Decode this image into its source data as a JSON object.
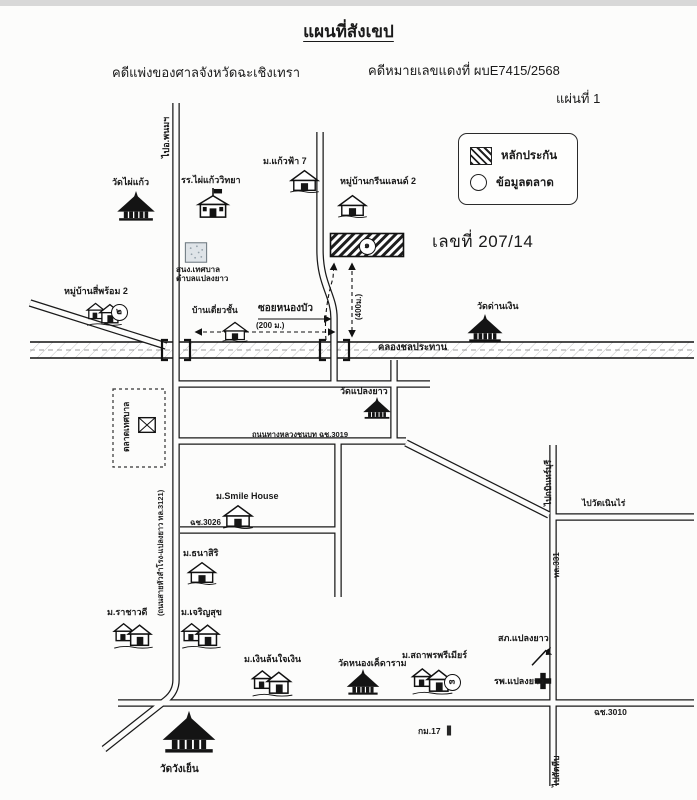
{
  "title": "แผนที่สังเขป",
  "header": {
    "court_line": "คดีแพ่งของศาลจังหวัดฉะเชิงเทรา",
    "case_no_line": "คดีหมายเลขแดงที่ ผบE7415/2568",
    "sheet_no": "แผ่นที่ 1"
  },
  "legend": {
    "collateral_label": "หลักประกัน",
    "market_label": "ข้อมูลตลาด"
  },
  "parcel": {
    "address_label": "เลขที่ 207/14"
  },
  "map": {
    "labels": [
      {
        "id": "to-phanom-road-label",
        "text": "ไปอ.พนมฯ",
        "x": 161,
        "y": 158,
        "rot": -90,
        "size": 9
      },
      {
        "id": "soi-nong-bua-label",
        "text": "ซอยหนองบัว",
        "x": 258,
        "y": 303,
        "size": 10,
        "bold": true
      },
      {
        "id": "soi-length-label",
        "text": "(200 ม.)",
        "x": 256,
        "y": 322,
        "size": 8
      },
      {
        "id": "parcel-distance-label",
        "text": "(400ม.)",
        "x": 355,
        "y": 320,
        "rot": -90,
        "size": 8
      },
      {
        "id": "canal-label",
        "text": "คลองชลประทาน",
        "x": 378,
        "y": 343,
        "size": 9.5,
        "bold": true
      },
      {
        "id": "road-3019-label",
        "text": "ถนนทางหลวงชนบท ฉช.3019",
        "x": 252,
        "y": 431,
        "size": 7.5
      },
      {
        "id": "road-3026-label",
        "text": "ฉช.3026",
        "x": 190,
        "y": 519,
        "size": 8
      },
      {
        "id": "road-3121-label",
        "text": "(ถนนสายหัวสำโรง-แปลงยาว ทล.3121)",
        "x": 157,
        "y": 616,
        "rot": -90,
        "size": 7.5
      },
      {
        "id": "municipal-market-label",
        "text": "ตลาดเทศบาล",
        "x": 122,
        "y": 452,
        "rot": -90,
        "size": 8.5
      },
      {
        "id": "highway-331-label",
        "text": "ทล.331",
        "x": 553,
        "y": 578,
        "rot": -90,
        "size": 8
      },
      {
        "id": "to-kabin-buri-label",
        "text": "ไปกบินทร์บุรี",
        "x": 544,
        "y": 506,
        "rot": -90,
        "size": 8.5
      },
      {
        "id": "to-wat-noen-rai-label",
        "text": "ไปวัดเนินไร่",
        "x": 582,
        "y": 499,
        "size": 8.5,
        "bold": true
      },
      {
        "id": "road-3010-label",
        "text": "ฉช.3010",
        "x": 594,
        "y": 708,
        "size": 8.5
      },
      {
        "id": "to-sattahip-label",
        "text": "ไปสัตหีบ",
        "x": 552,
        "y": 787,
        "rot": -90,
        "size": 8.5
      },
      {
        "id": "km-marker-label",
        "text": "กม.17",
        "x": 418,
        "y": 727,
        "size": 8.5
      }
    ],
    "places": [
      {
        "id": "wat-phai-kaeo",
        "name": "วัดไผ่แก้ว",
        "icon": "temple",
        "ix": 114,
        "iy": 191,
        "iw": 44,
        "ih": 30,
        "lx": 112,
        "ly": 177
      },
      {
        "id": "school-phai-kaeo-wittaya",
        "name": "รร.ไผ่แก้ววิทยา",
        "icon": "school",
        "ix": 193,
        "iy": 188,
        "iw": 40,
        "ih": 33,
        "lx": 181,
        "ly": 175
      },
      {
        "id": "mu-kaeo-fa-7",
        "name": "ม.แก้วฟ้า 7",
        "icon": "house",
        "ix": 288,
        "iy": 168,
        "iw": 33,
        "ih": 25,
        "lx": 263,
        "ly": 156
      },
      {
        "id": "mu-ban-green-land-2",
        "name": "หมู่บ้านกรีนแลนด์ 2",
        "icon": "house",
        "ix": 336,
        "iy": 193,
        "iw": 33,
        "ih": 25,
        "lx": 340,
        "ly": 176
      },
      {
        "id": "municipal-office",
        "name": "สนง.เทศบาล",
        "name2": "ตำบลแปลงยาว",
        "icon": "office",
        "ix": 183,
        "iy": 241,
        "iw": 26,
        "ih": 23,
        "lx": 176,
        "ly": 266,
        "ls": 8
      },
      {
        "id": "mu-ban-si-phrom-2",
        "name": "หมู่บ้านสี่พร้อม 2",
        "icon": "village",
        "ix": 85,
        "iy": 300,
        "iw": 38,
        "ih": 27,
        "lx": 64,
        "ly": 286
      },
      {
        "id": "detached-house",
        "name": "บ้านเดี่ยวชั้น",
        "icon": "house",
        "ix": 221,
        "iy": 320,
        "iw": 28,
        "ih": 22,
        "lx": 192,
        "ly": 306,
        "ls": 8.5
      },
      {
        "id": "wat-dan-ngoen",
        "name": "วัดด่านเงิน",
        "icon": "temple",
        "ix": 463,
        "iy": 314,
        "iw": 44,
        "ih": 28,
        "lx": 477,
        "ly": 301
      },
      {
        "id": "wat-plaeng-yao",
        "name": "วัดแปลงยาว",
        "icon": "temple",
        "ix": 360,
        "iy": 397,
        "iw": 34,
        "ih": 22,
        "lx": 340,
        "ly": 386
      },
      {
        "id": "municipal-market-stall",
        "name": "",
        "icon": "market",
        "ix": 136,
        "iy": 414,
        "iw": 22,
        "ih": 22
      },
      {
        "id": "mu-smile-house",
        "name": "ม.Smile House",
        "icon": "house",
        "ix": 221,
        "iy": 503,
        "iw": 34,
        "ih": 26,
        "lx": 216,
        "ly": 491
      },
      {
        "id": "mu-thanasiri",
        "name": "ม.ธนาสิริ",
        "icon": "house",
        "ix": 186,
        "iy": 560,
        "iw": 32,
        "ih": 25,
        "lx": 183,
        "ly": 548
      },
      {
        "id": "mu-rachawadee",
        "name": "ม.ราชาวดี",
        "icon": "village",
        "ix": 112,
        "iy": 620,
        "iw": 42,
        "ih": 30,
        "lx": 107,
        "ly": 607
      },
      {
        "id": "mu-charoensuk",
        "name": "ม.เจริญสุข",
        "icon": "village",
        "ix": 180,
        "iy": 620,
        "iw": 42,
        "ih": 30,
        "lx": 181,
        "ly": 607
      },
      {
        "id": "mu-ngoen-lon-jai-ngoen",
        "name": "ม.เงินล้นใจเงิน",
        "icon": "village",
        "ix": 250,
        "iy": 667,
        "iw": 44,
        "ih": 31,
        "lx": 244,
        "ly": 654
      },
      {
        "id": "wat-nong-khet-aram",
        "name": "วัดหนองเค็ดาราม",
        "icon": "temple",
        "ix": 344,
        "iy": 669,
        "iw": 38,
        "ih": 26,
        "lx": 338,
        "ly": 658
      },
      {
        "id": "mu-sathaporn-premier",
        "name": "ม.สถาพรพรีเมียร์",
        "icon": "village",
        "ix": 410,
        "iy": 665,
        "iw": 44,
        "ih": 31,
        "lx": 402,
        "ly": 650
      },
      {
        "id": "police-station-plaeng-yao",
        "name": "สภ.แปลงยาว",
        "icon": "police",
        "ix": 528,
        "iy": 644,
        "iw": 24,
        "ih": 23,
        "lx": 498,
        "ly": 633
      },
      {
        "id": "hospital-plaeng-yao",
        "name": "รพ.แปลงยาว",
        "icon": "hospital",
        "ix": 533,
        "iy": 671,
        "iw": 20,
        "ih": 20,
        "lx": 494,
        "ly": 676
      },
      {
        "id": "wat-wang-yen",
        "name": "วัดวังเย็น",
        "icon": "temple",
        "ix": 160,
        "iy": 707,
        "iw": 58,
        "ih": 50,
        "lx": 160,
        "ly": 764,
        "ls": 10
      },
      {
        "id": "km-post",
        "name": "",
        "icon": "km",
        "ix": 444,
        "iy": 724,
        "iw": 10,
        "ih": 13
      }
    ],
    "markers": [
      {
        "id": "collateral-parcel-marker",
        "num": "๑",
        "cx": 366,
        "cy": 245
      },
      {
        "id": "market-data-marker-2",
        "num": "๒",
        "cx": 118,
        "cy": 311
      },
      {
        "id": "market-data-marker-3",
        "num": "๓",
        "cx": 451,
        "cy": 681
      }
    ]
  }
}
